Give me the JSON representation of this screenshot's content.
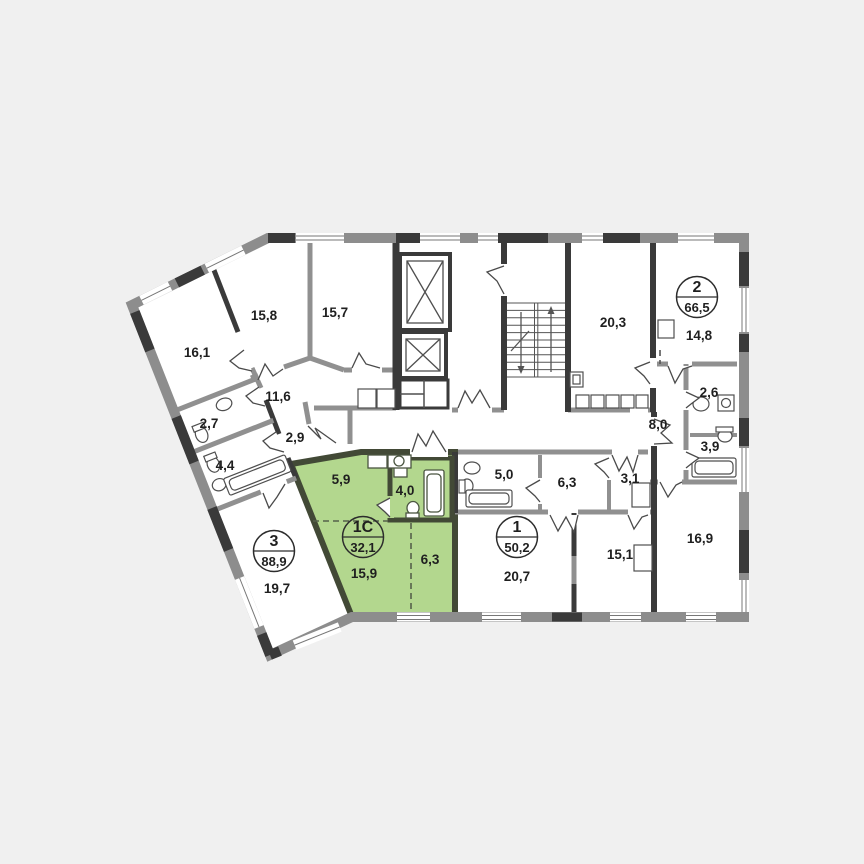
{
  "plan": {
    "type": "apartment-floor-plan",
    "highlight_color": "#b3d78e",
    "wall_color": "#8d8d8d",
    "dark_wall_color": "#3a3a3a",
    "apartments": [
      {
        "number": "2",
        "area": "66,5",
        "highlighted": false
      },
      {
        "number": "3",
        "area": "88,9",
        "highlighted": false
      },
      {
        "number": "1",
        "area": "50,2",
        "highlighted": false
      },
      {
        "number": "1С",
        "area": "32,1",
        "highlighted": true
      }
    ],
    "rooms": [
      {
        "label": "16,1"
      },
      {
        "label": "15,8"
      },
      {
        "label": "15,7"
      },
      {
        "label": "11,6"
      },
      {
        "label": "2,7"
      },
      {
        "label": "4,4"
      },
      {
        "label": "2,9"
      },
      {
        "label": "19,7"
      },
      {
        "label": "20,3"
      },
      {
        "label": "14,8"
      },
      {
        "label": "2,6"
      },
      {
        "label": "8,0"
      },
      {
        "label": "3,9"
      },
      {
        "label": "16,9"
      },
      {
        "label": "5,0"
      },
      {
        "label": "6,3"
      },
      {
        "label": "3,1"
      },
      {
        "label": "20,7"
      },
      {
        "label": "15,1"
      },
      {
        "label": "5,9"
      },
      {
        "label": "4,0"
      },
      {
        "label": "15,9"
      },
      {
        "label": "6,3"
      }
    ]
  }
}
